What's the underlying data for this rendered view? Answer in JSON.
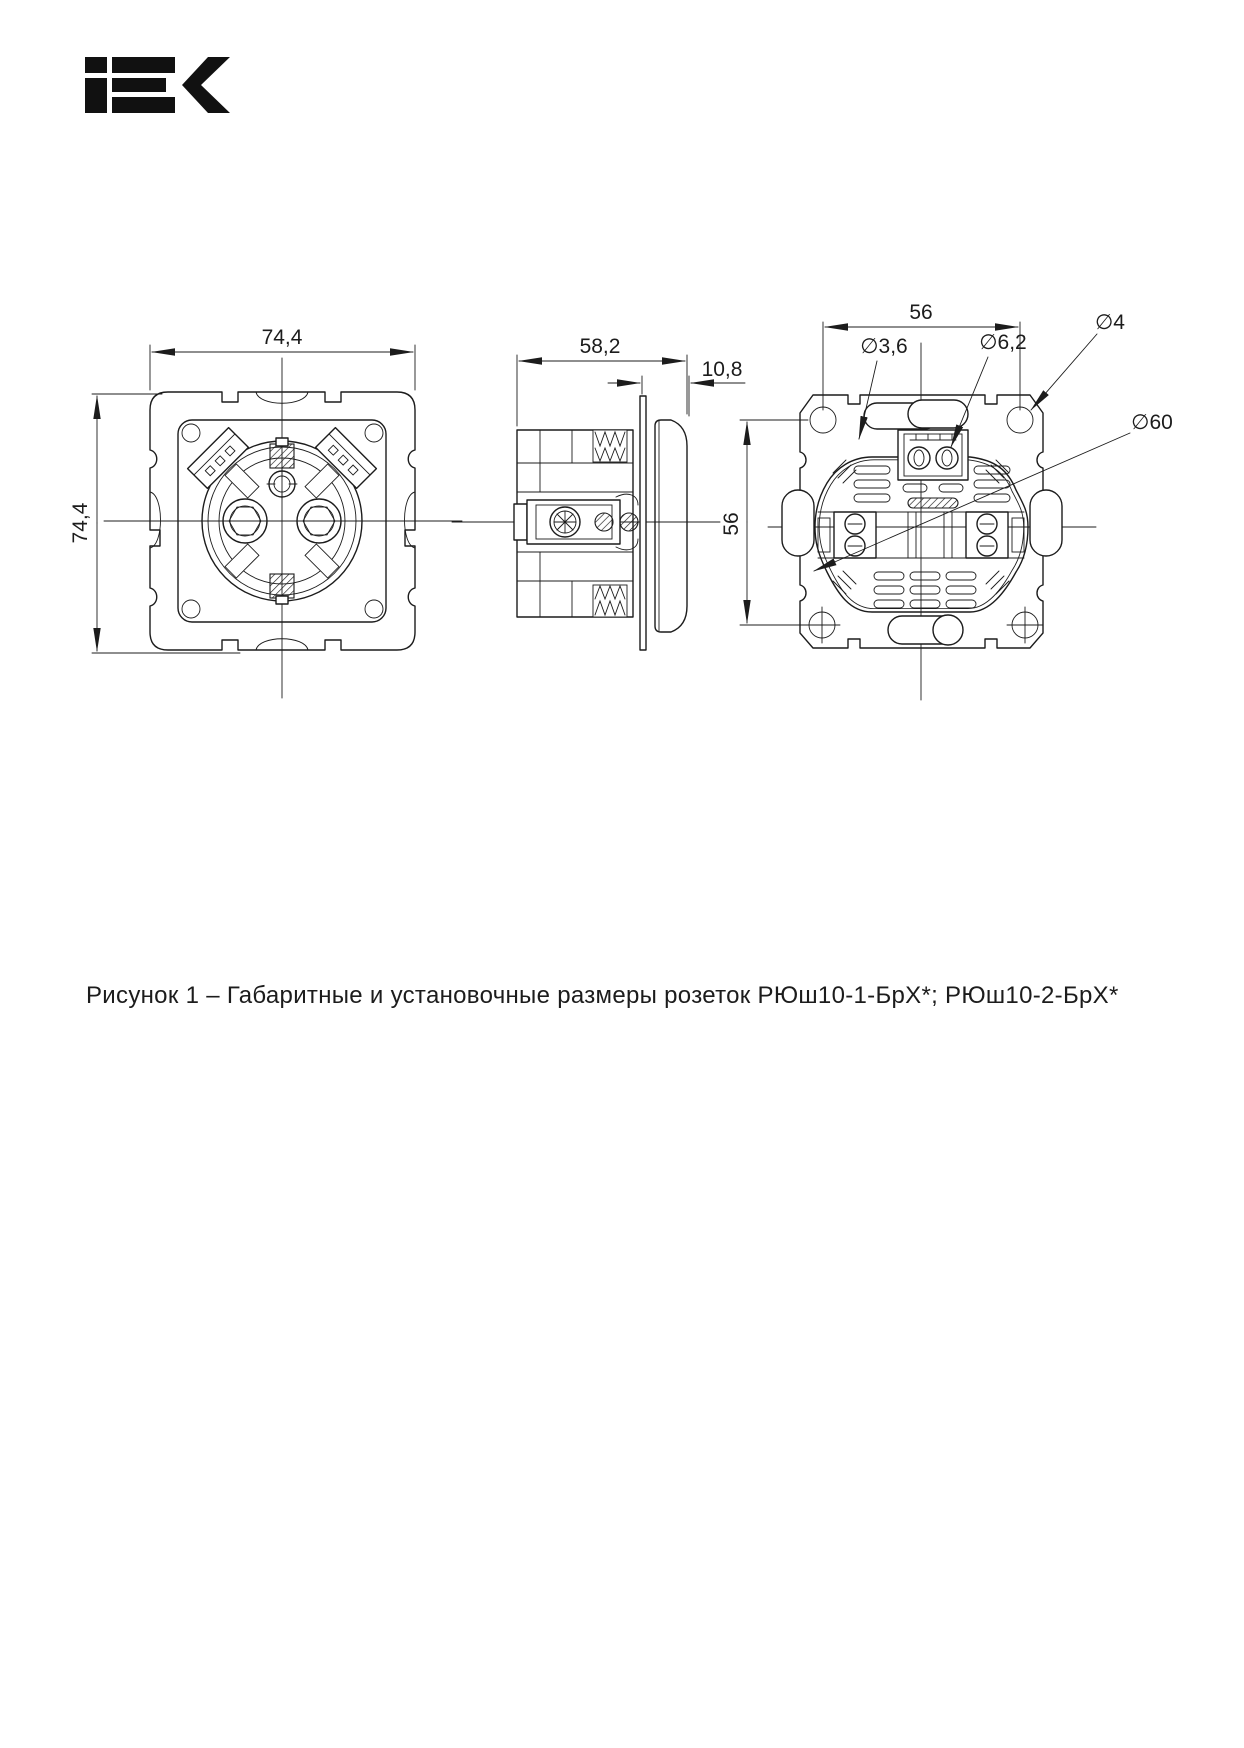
{
  "logo": {
    "name": "IEK"
  },
  "drawing": {
    "front_view": {
      "width_label": "74,4",
      "height_label": "74,4"
    },
    "side_view": {
      "depth_label": "58,2",
      "offset_label": "10,8"
    },
    "back_view": {
      "hole_spacing_horizontal_label": "56",
      "hole_spacing_vertical_label": "56",
      "callout_claw_hole": "∅3,6",
      "callout_terminal_screw": "∅6,2",
      "callout_mounting_hole": "∅4",
      "callout_body_diameter": "∅60"
    }
  },
  "caption": {
    "text": "Рисунок 1 – Габаритные и установочные размеры розеток РЮш10-1-БрХ*; РЮш10-2-БрХ*"
  },
  "colors": {
    "line": "#1c1c1c",
    "background": "#ffffff",
    "logo": "#111111"
  }
}
